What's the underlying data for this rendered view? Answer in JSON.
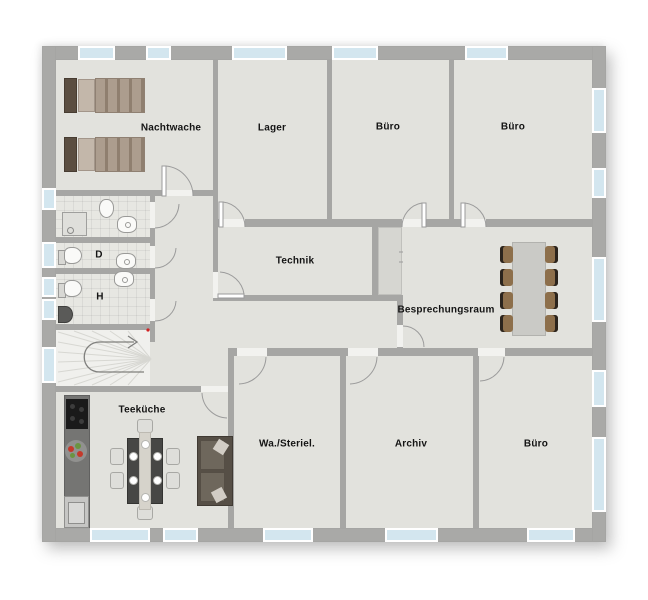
{
  "floorplan": {
    "rooms": {
      "nachtwache": {
        "label": "Nachtwache"
      },
      "lager": {
        "label": "Lager"
      },
      "buero_top_1": {
        "label": "Büro"
      },
      "buero_top_2": {
        "label": "Büro"
      },
      "technik": {
        "label": "Technik"
      },
      "besprechungsraum": {
        "label": "Besprechungsraum"
      },
      "teekueche": {
        "label": "Teeküche"
      },
      "wa_steriel": {
        "label": "Wa./Steriel."
      },
      "archiv": {
        "label": "Archiv"
      },
      "buero_bottom": {
        "label": "Büro"
      },
      "wc_damen": {
        "label": "D"
      },
      "wc_herren": {
        "label": "H"
      }
    },
    "colors": {
      "wall": "#a6a6a4",
      "floor": "#e2e2dd",
      "window_glass": "#d3e6ef",
      "bed_wood": "#5b4e41",
      "bedding": "#ab9c8d",
      "chair_brown": "#8d6f4b",
      "meeting_table": "#cacac6",
      "sofa": "#5c544a",
      "kitchen_counter": "#757573",
      "stove": "#1a1a1a",
      "fruit_red": "#c4392b",
      "fruit_green": "#6a9440",
      "stair_arrow": "#7f7f7d",
      "marker_red": "#d22222"
    },
    "icons": {
      "stair_direction_arrow": "u-turn-arrow-right"
    }
  }
}
